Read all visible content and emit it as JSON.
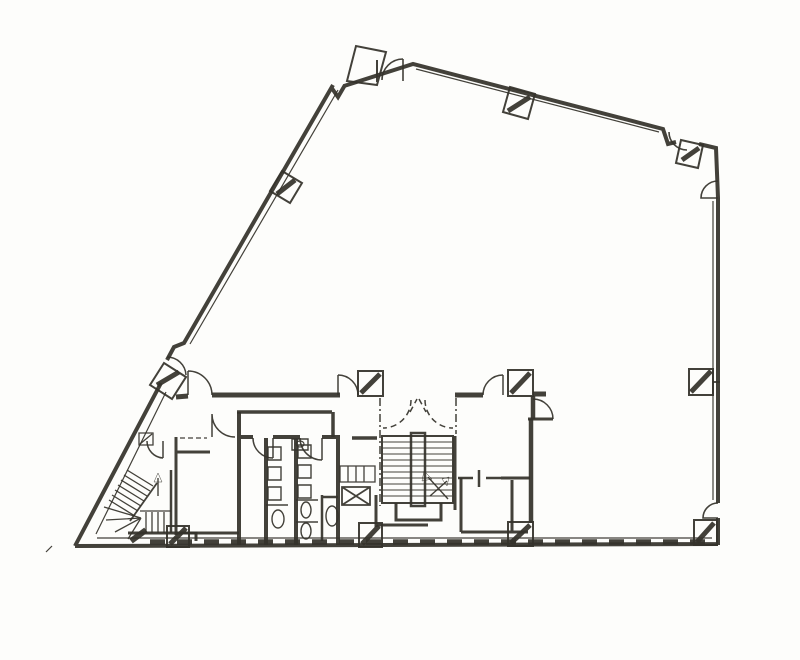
{
  "meta": {
    "diagram_type": "scanned architectural floor plan",
    "background_color": "#fdfdfb",
    "ink_color": "#35332b",
    "hatch_color": "#49543f",
    "visible_text": "none"
  },
  "features": [
    "building-perimeter",
    "entrance-bay",
    "structural-columns",
    "main-switchback-stair",
    "elevator-lobby-dashed-doors",
    "fire-escape-stair",
    "toilet-block",
    "accessible-wc",
    "duct-shaft",
    "service-room",
    "store-room",
    "door-swing-arcs"
  ],
  "shapes": [
    {
      "n": "perimeter-walls",
      "t": "path",
      "a": {
        "d": "M75,546 L161,383 M167,360 L174,347 L184,343 L333,85 M331,87 L338,97 L345,85 M344,86 L413,64 L663,129 L668,144 L676,142 M699,144 L716,148 L718,198 L718,503 M718,518 L718,545 M718,544 L75,546",
        "stroke-width": "4"
      }
    },
    {
      "n": "inner-wall-lines",
      "t": "path",
      "a": {
        "d": "M338,90 L190,344 M166,392 L96,534 M416,69 L659,132 M713,201 L713,500 M97,538 L712,538",
        "stroke-width": "1.2"
      }
    },
    {
      "n": "bottom-wall-hatch",
      "t": "line",
      "a": {
        "x1": "150",
        "y1": "542",
        "x2": "710",
        "y2": "542",
        "stroke-width": "5.5",
        "stroke-dasharray": "15 12",
        "stroke": "#49543f"
      }
    },
    {
      "n": "entrance-bay",
      "t": "path",
      "a": {
        "d": "M347,81 L356,46 L386,52 L377,85 Z M377,60 L377,82",
        "fill": "#fdfdfb",
        "stroke-width": "2"
      }
    },
    {
      "n": "entrance-bay-door",
      "t": "path",
      "a": {
        "d": "M403,59 L403,81 M403,59 A21,21 0 0 0 382,80",
        "stroke-width": "1.6"
      }
    },
    {
      "n": "corner-door-top-right",
      "t": "path",
      "a": {
        "d": "M669,132 A18,18 0 0 0 687,150",
        "stroke-width": "1.6"
      }
    },
    {
      "n": "right-wall-door-top",
      "t": "path",
      "a": {
        "d": "M718,181 A17,17 0 0 0 701,198 L718,198",
        "stroke-width": "1.6"
      }
    },
    {
      "n": "right-wall-door-bottom",
      "t": "path",
      "a": {
        "d": "M718,503 A15,15 0 0 0 703,518 L718,518",
        "stroke-width": "1.6"
      }
    },
    {
      "n": "core-top-wall",
      "t": "path",
      "a": {
        "d": "M176,397 L188,396 M212,395 L340,395 M455,395 L483,395 M533,394 L546,394",
        "stroke-width": "5"
      }
    },
    {
      "n": "columns-rotated",
      "t": "path",
      "a": {
        "d": "M302,183 L282,171 L270,191 L290,203 Z M528,119 L535,94 L510,87 L503,112 Z M681,140 L703,145 L698,168 L676,163 Z M186,377 L164,363 L150,385 L172,399 Z",
        "fill": "#fdfdfb",
        "stroke-width": "2"
      }
    },
    {
      "n": "columns-square",
      "t": "path",
      "a": {
        "d": "M689,369 h24 v26 h-24 Z M694,520 h23 v25 h-23 Z M508,522 h25 v24 h-25 Z M359,523 h23 v24 h-23 Z M167,526 h22 v21 h-22 Z M358,371 h25 v25 h-25 Z M508,370 h25 v26 h-25 Z",
        "fill": "#fdfdfb",
        "stroke-width": "2"
      }
    },
    {
      "n": "column-hatch-marks",
      "t": "path",
      "a": {
        "d": "M277,194 L295,180 M508,111 L530,97 M682,160 L699,148 M691,392 L711,371 M697,542 L714,523 M511,543 L530,525 M362,544 L379,526 M170,544 L186,528 M157,385 L179,372 M361,393 L380,374 M511,393 L530,373",
        "stroke-width": "5",
        "stroke": "#49543f"
      }
    },
    {
      "n": "column-stub",
      "t": "line",
      "a": {
        "x1": "713",
        "y1": "382",
        "x2": "720",
        "y2": "382",
        "stroke-width": "1.8"
      }
    },
    {
      "n": "core-door-swings",
      "t": "path",
      "a": {
        "d": "M212,395 A24,24 0 0 0 188,371 M188,371 L188,395 M338,375 A20,20 0 0 1 358,395 M338,375 L338,395 M483,395 A20,20 0 0 1 503,375 M503,375 L503,395",
        "stroke-width": "1.5"
      }
    },
    {
      "n": "right-room-door",
      "t": "path",
      "a": {
        "d": "M533,399 A20,20 0 0 1 553,419",
        "stroke-width": "1.5"
      }
    },
    {
      "n": "right-room-door-stub",
      "t": "line",
      "a": {
        "x1": "528",
        "y1": "419",
        "x2": "553",
        "y2": "419",
        "stroke-width": "3"
      }
    },
    {
      "n": "lobby-right-wall",
      "t": "path",
      "a": {
        "d": "M533,396 L533,419 M531,419 L531,523",
        "stroke-width": "4.5"
      }
    },
    {
      "n": "lobby-dashed-boundary",
      "t": "path",
      "a": {
        "d": "M380,398 L380,506 M456,398 L456,434",
        "stroke-width": "1.5",
        "stroke-dasharray": "8 3 2 3"
      }
    },
    {
      "n": "lobby-dashed-doors",
      "t": "path",
      "a": {
        "d": "M411,400 A28,28 0 0 1 383,428 M425,400 A28,28 0 0 0 453,428 M410,412 L417,399 M419,399 L426,412",
        "stroke-width": "1.5",
        "stroke-dasharray": "6 4"
      }
    },
    {
      "n": "main-stair-outline",
      "t": "rect",
      "a": {
        "x": "382",
        "y": "436",
        "width": "71",
        "height": "67",
        "stroke-width": "2"
      }
    },
    {
      "n": "main-stair-treads",
      "t": "path",
      "a": {
        "d": "M383,442 H452 M383,448 H452 M383,454 H452 M383,460 H452 M383,466 H452 M383,472 H452 M383,478 H452 M383,484 H452 M383,490 H452 M383,496 H452",
        "stroke-width": "1"
      }
    },
    {
      "n": "main-stair-core",
      "t": "rect",
      "a": {
        "x": "411",
        "y": "433",
        "width": "14",
        "height": "73",
        "fill": "#fdfdfb",
        "stroke-width": "2.5"
      }
    },
    {
      "n": "main-stair-arrows",
      "t": "path",
      "a": {
        "d": "M448,499 L428,477 M430,496 L447,481",
        "stroke-width": "1.4"
      }
    },
    {
      "n": "main-stair-arrowheads",
      "t": "path",
      "a": {
        "d": "M424,471 L432,479 L422,481 Z M449,477 L442,479 L447,486 Z",
        "fill": "#35332b",
        "stroke-width": "0.5"
      }
    },
    {
      "n": "stair-lower-landing",
      "t": "path",
      "a": {
        "d": "M396,503 L396,520 L441,520 L441,503 M376,495 L376,527 M376,525 L428,525 M455,436 L455,510",
        "stroke-width": "3"
      }
    },
    {
      "n": "service-threshold",
      "t": "path",
      "a": {
        "d": "M458,478 L473,478 M486,478 L501,478 M479,470 L479,487",
        "stroke-width": "2.5"
      }
    },
    {
      "n": "service-room",
      "t": "path",
      "a": {
        "d": "M461,478 L461,532 M461,532 L528,532 M512,480 L512,532 M501,478 L530,478",
        "stroke-width": "3"
      }
    },
    {
      "n": "toilet-walls",
      "t": "path",
      "a": {
        "d": "M239,412 L239,545 M266,438 L266,545 M296,438 L296,545 M338,437 L338,545 M239,437 L253,437 M273,437 L300,437 M322,437 L340,437",
        "stroke-width": "4"
      }
    },
    {
      "n": "toilet-door-swings",
      "t": "path",
      "a": {
        "d": "M253,438 A20,20 0 0 0 273,458 M273,438 L273,458 M300,438 A22,22 0 0 0 322,460 M322,438 L322,460",
        "stroke-width": "1.5"
      }
    },
    {
      "n": "toilet-fixtures",
      "t": "path",
      "a": {
        "d": "M268,447 h13 v13 h-13 Z M268,467 h13 v13 h-13 Z M268,487 h13 v13 h-13 Z M298,445 h13 v13 h-13 Z M298,465 h13 v13 h-13 Z M298,485 h13 v13 h-13 Z M266,505 L288,505 M296,500 L318,500 M296,522 L318,522 M292,439 h16 v11 h-16 Z",
        "stroke-width": "1.4"
      }
    },
    {
      "n": "wc-bowl-1",
      "t": "ellipse",
      "a": {
        "cx": "278",
        "cy": "519",
        "rx": "6",
        "ry": "9",
        "stroke-width": "1.4"
      }
    },
    {
      "n": "wc-bowl-2",
      "t": "ellipse",
      "a": {
        "cx": "306",
        "cy": "510",
        "rx": "5",
        "ry": "8",
        "stroke-width": "1.4"
      }
    },
    {
      "n": "wc-bowl-3",
      "t": "ellipse",
      "a": {
        "cx": "306",
        "cy": "531",
        "rx": "5",
        "ry": "8",
        "stroke-width": "1.4"
      }
    },
    {
      "n": "wc-bowl-4",
      "t": "ellipse",
      "a": {
        "cx": "332",
        "cy": "516",
        "rx": "6",
        "ry": "10",
        "stroke-width": "1.4"
      }
    },
    {
      "n": "basin-oval",
      "t": "ellipse",
      "a": {
        "cx": "300",
        "cy": "444",
        "rx": "4",
        "ry": "3",
        "stroke-width": "1.2"
      }
    },
    {
      "n": "accessible-wc-walls",
      "t": "path",
      "a": {
        "d": "M322,495 L322,541 M322,497 L338,497",
        "stroke-width": "2.5"
      }
    },
    {
      "n": "duct-shaft",
      "t": "path",
      "a": {
        "d": "M342,487 h28 v18 h-28 Z M342,505 L370,487 M342,487 L370,505",
        "fill": "#fdfdfb",
        "stroke-width": "1.8"
      }
    },
    {
      "n": "sink-counter",
      "t": "path",
      "a": {
        "d": "M340,466 h35 v16 h-35 Z M348,466 L348,482 M356,466 L356,482 M364,466 L364,482",
        "stroke-width": "1.3"
      }
    },
    {
      "n": "store-room-walls",
      "t": "path",
      "a": {
        "d": "M176,437 L176,535 M176,452 L210,452 M176,533 L239,533",
        "stroke-width": "3"
      }
    },
    {
      "n": "store-room-door",
      "t": "path",
      "a": {
        "d": "M212,414 A23,23 0 0 0 235,437 M212,414 L212,437",
        "stroke-width": "1.5"
      }
    },
    {
      "n": "corridor-walls",
      "t": "path",
      "a": {
        "d": "M237,412 L332,412 M333,412 L333,437 M352,438 L377,438",
        "stroke-width": "3.5"
      }
    },
    {
      "n": "overhead-dashed-line",
      "t": "path",
      "a": {
        "d": "M180,438 L207,438",
        "stroke-width": "1.2",
        "stroke-dasharray": "5 3"
      }
    },
    {
      "n": "fire-stair-upper-treads",
      "t": "path",
      "a": {
        "d": "M109,500 L135,516 M112,495 L138,511 M115,490 L141,506 M118,485 L144,501 M121,480 L147,496 M124,475 L150,491 M127,470 L153,486",
        "stroke-width": "1.3"
      }
    },
    {
      "n": "fire-stair-stringer",
      "t": "line",
      "a": {
        "x1": "130",
        "y1": "521",
        "x2": "157",
        "y2": "483",
        "stroke-width": "1.8"
      }
    },
    {
      "n": "fire-stair-winders",
      "t": "path",
      "a": {
        "d": "M141,518 L104,507 M141,518 L106,520 M141,518 L115,532 M141,518 L128,539",
        "stroke-width": "1.3"
      }
    },
    {
      "n": "fire-stair-lower-treads",
      "t": "path",
      "a": {
        "d": "M146,512 L146,533 M152,512 L152,533 M158,512 L158,533 M164,512 L164,533 M140,511 L171,511",
        "stroke-width": "1.3"
      }
    },
    {
      "n": "fire-stair-center-wall",
      "t": "line",
      "a": {
        "x1": "171",
        "y1": "470",
        "x2": "171",
        "y2": "533",
        "stroke-width": "2.5"
      }
    },
    {
      "n": "fire-stair-arrow",
      "t": "path",
      "a": {
        "d": "M158,496 L158,478",
        "stroke-width": "1.4"
      }
    },
    {
      "n": "fire-stair-arrowhead",
      "t": "path",
      "a": {
        "d": "M154,482 L158,473 L162,482 Z",
        "fill": "#35332b",
        "stroke-width": "0.5"
      }
    },
    {
      "n": "fire-stair-walls",
      "t": "path",
      "a": {
        "d": "M128,533 L196,533 L196,541",
        "stroke-width": "3"
      }
    },
    {
      "n": "fire-stair-hatch",
      "t": "line",
      "a": {
        "x1": "131",
        "y1": "541",
        "x2": "146",
        "y2": "530",
        "stroke-width": "6",
        "stroke": "#49543f"
      }
    },
    {
      "n": "fire-stair-door",
      "t": "path",
      "a": {
        "d": "M147,441 A17,17 0 0 0 163,458 M163,441 L163,458",
        "stroke-width": "1.5"
      }
    },
    {
      "n": "fire-stair-door-box",
      "t": "path",
      "a": {
        "d": "M139,433 h14 v12 h-14 Z M140,444 L152,434",
        "stroke-width": "1.3"
      }
    },
    {
      "n": "slant-wall-door",
      "t": "path",
      "a": {
        "d": "M167,357 A19,19 0 0 1 186,375",
        "stroke-width": "1.5"
      }
    },
    {
      "n": "stray-scan-mark",
      "t": "line",
      "a": {
        "x1": "46",
        "y1": "552",
        "x2": "52",
        "y2": "546",
        "stroke-width": "1.2"
      }
    }
  ]
}
